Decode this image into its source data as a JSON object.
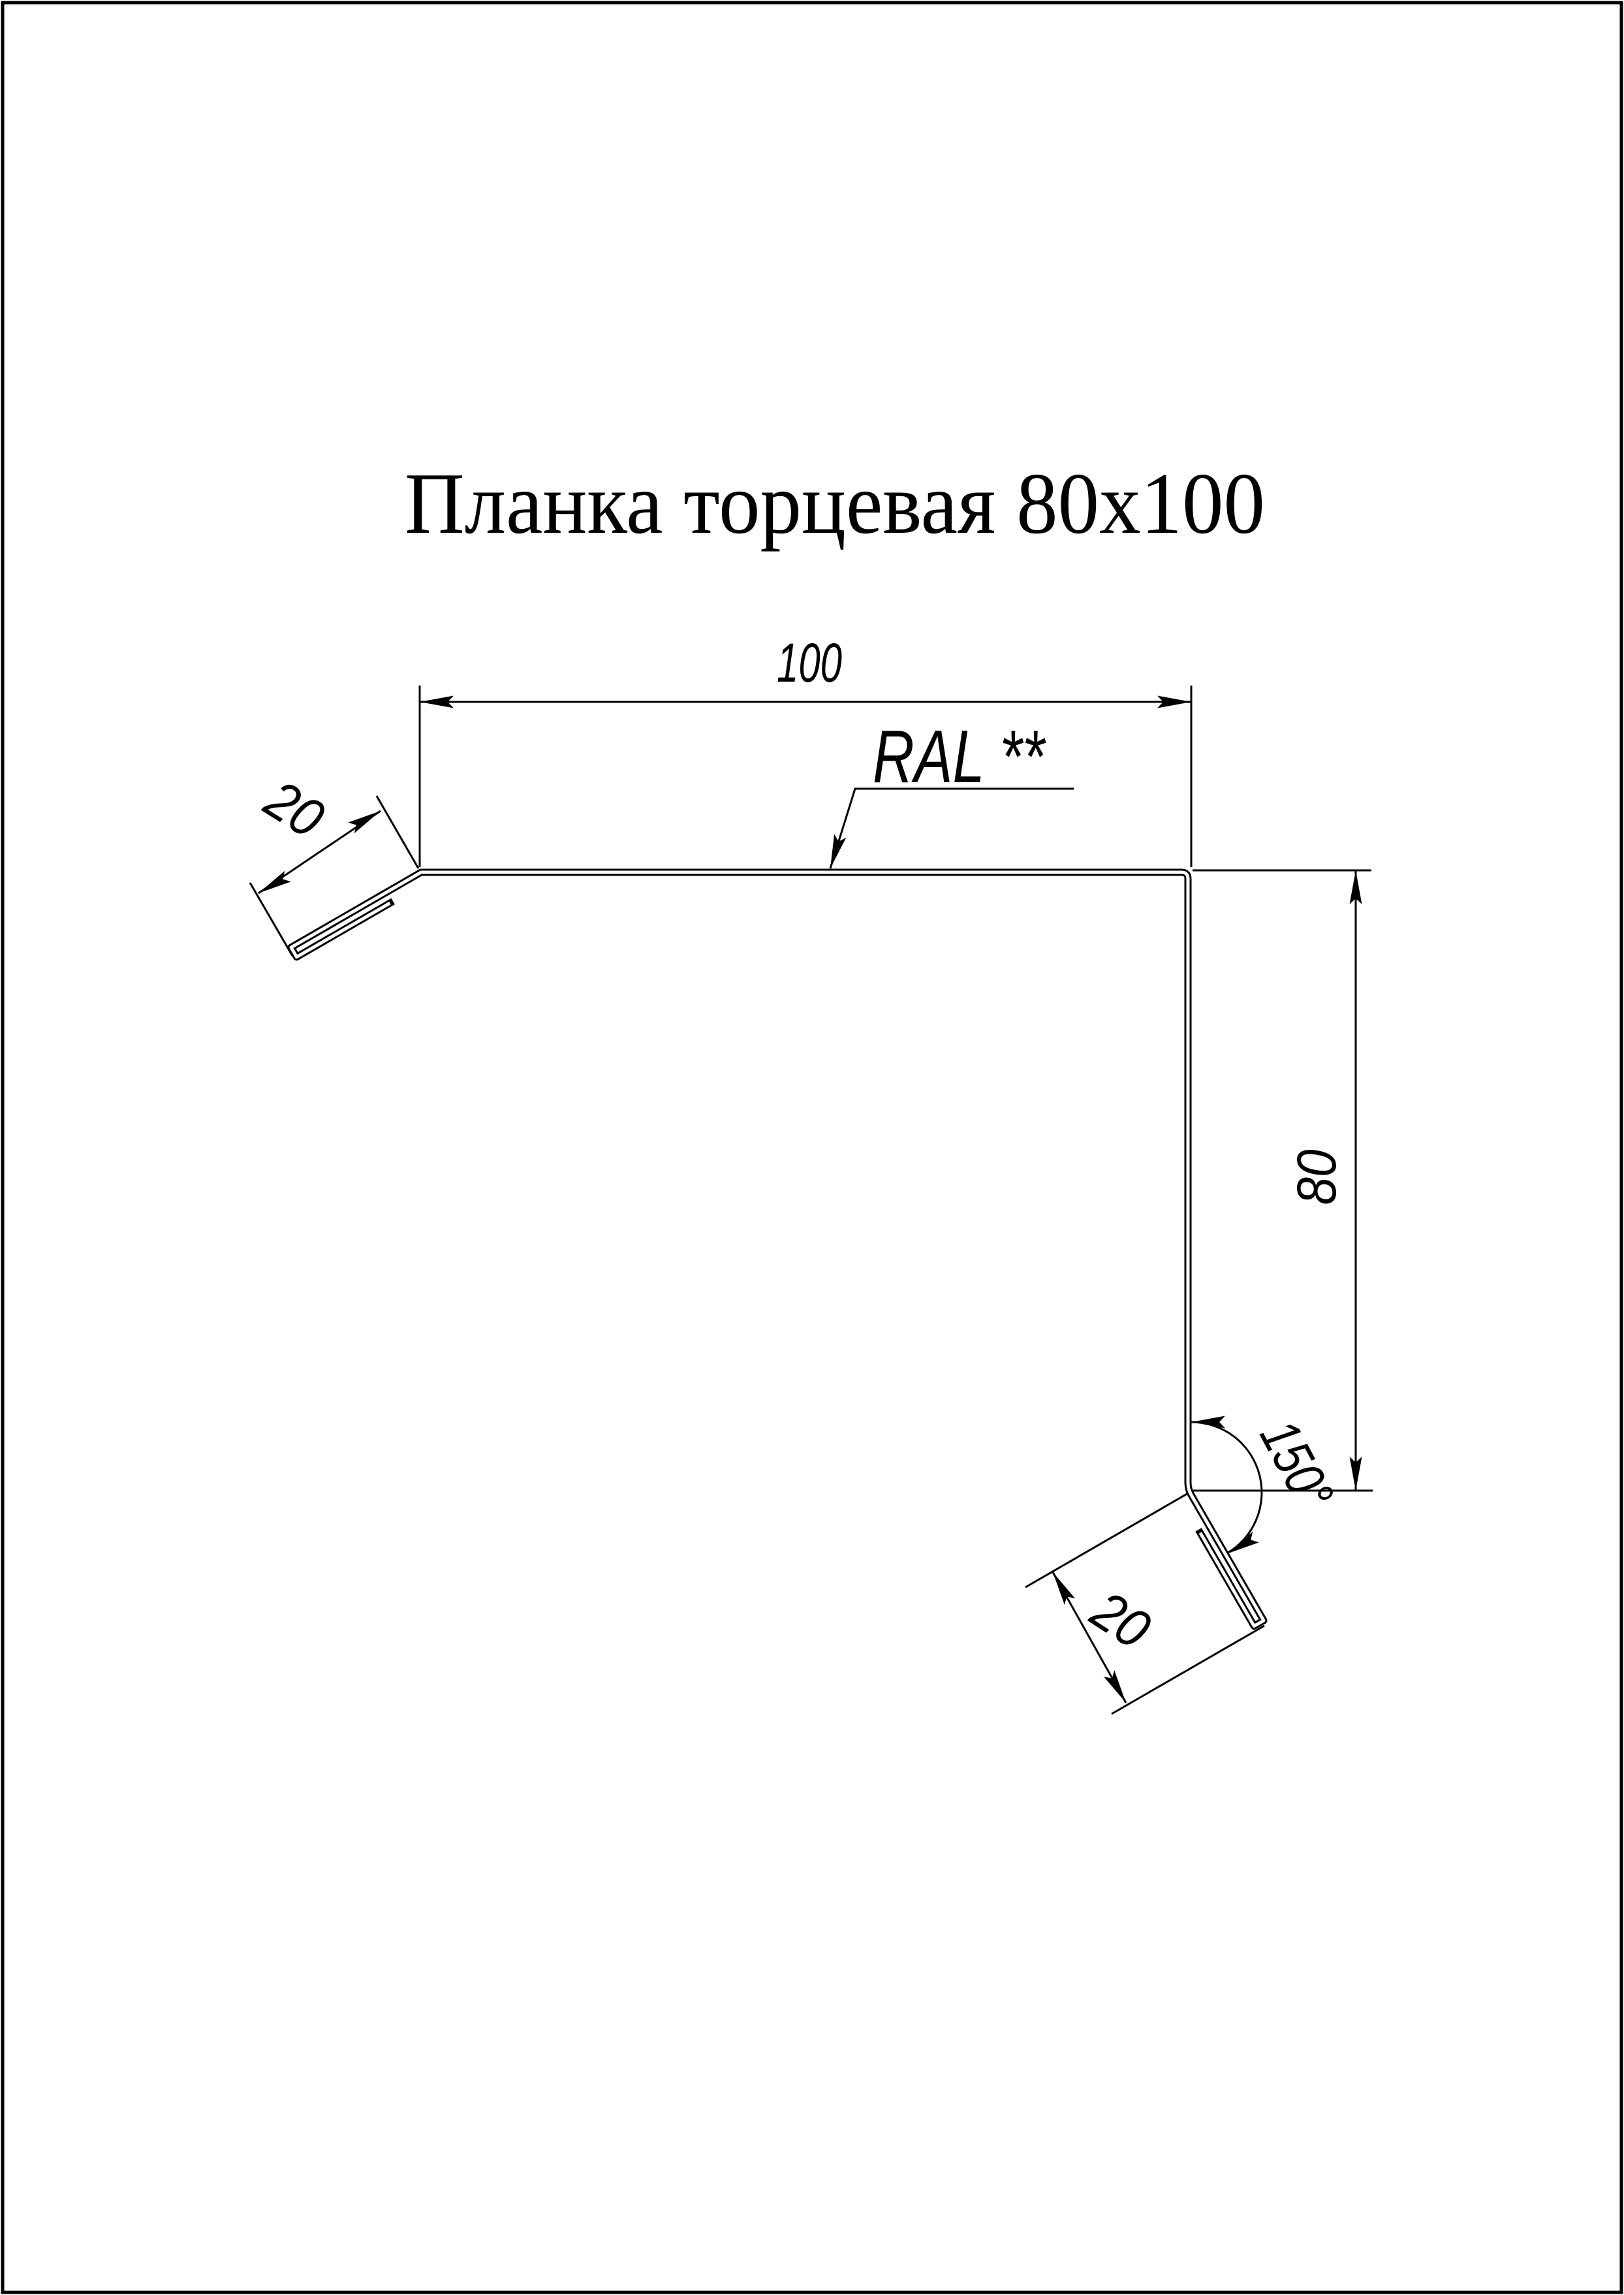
{
  "page": {
    "background_color": "#ffffff",
    "line_color": "#000000"
  },
  "title": "Планка торцевая 80x100",
  "drawing": {
    "material_label": "RAL **",
    "dimensions": {
      "top_width": "100",
      "right_height": "80",
      "top_flange": "20",
      "bottom_flange": "20",
      "bend_angle": "150°"
    }
  }
}
